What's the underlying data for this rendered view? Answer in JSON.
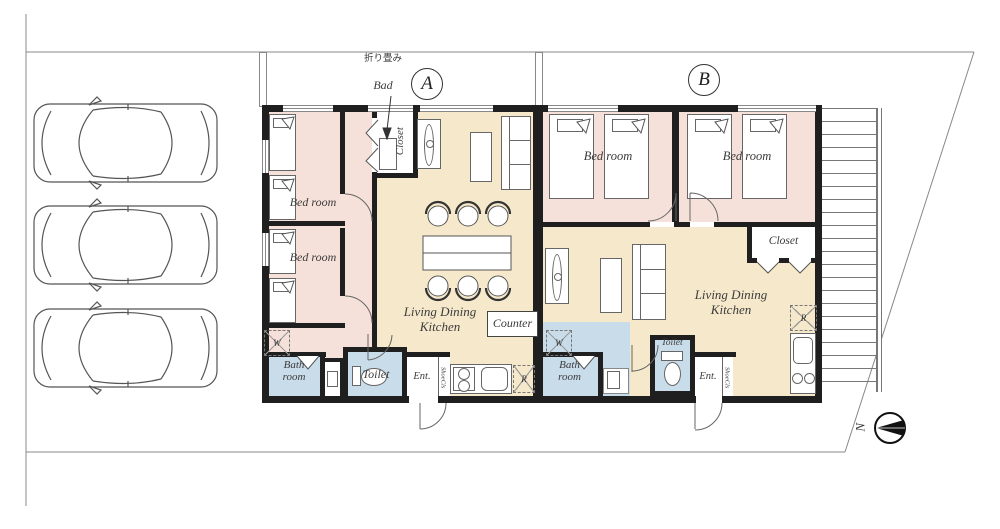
{
  "site": {
    "compass": {
      "north_label": "N"
    },
    "parking": {
      "car_count": 3
    }
  },
  "unit_a": {
    "unit_label": "A",
    "bedroom1": "Bed room",
    "bedroom2": "Bed room",
    "closet": "Closet",
    "folding_note_jp": "折り畳み",
    "folding_note_en": "Bad",
    "living1": "Living Dining",
    "living2": "Kitchen",
    "counter": "Counter",
    "bath1": "Bath",
    "bath2": "room",
    "toilet": "Toilet",
    "entrance": "Ent.",
    "shoe_closet": "ShoeCls",
    "washer": "W",
    "refrigerator": "R"
  },
  "unit_b": {
    "unit_label": "B",
    "bedroom1": "Bed room",
    "bedroom2": "Bed room",
    "closet": "Closet",
    "living1": "Living Dining",
    "living2": "Kitchen",
    "bath1": "Bath",
    "bath2": "room",
    "toilet": "Toilet",
    "entrance": "Ent.",
    "shoe_closet": "ShoeCls",
    "washer": "W",
    "refrigerator": "R"
  },
  "colors": {
    "wall": "#1f1f1f",
    "bedroom_floor": "#f5e1da",
    "living_floor": "#f6e9cb",
    "wet_area_floor": "#c9dcea",
    "line": "#888888"
  }
}
